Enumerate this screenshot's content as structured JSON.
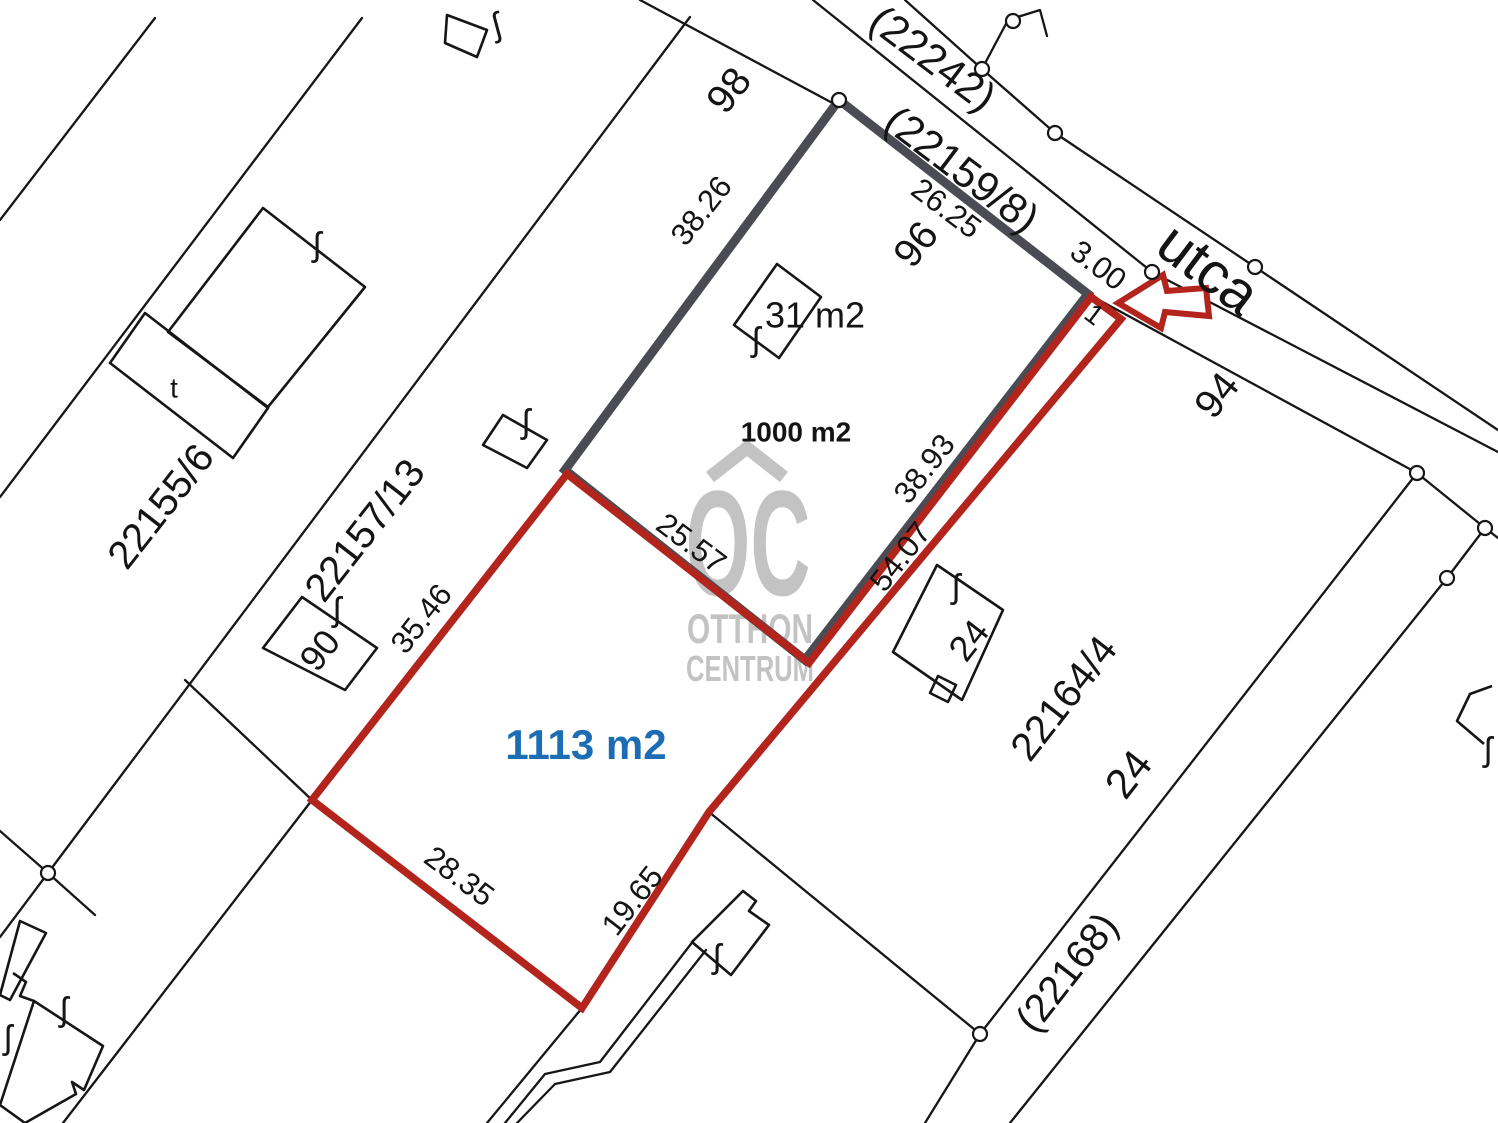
{
  "map": {
    "title": "cadastral-parcel-map",
    "canvas": {
      "width": 1498,
      "height": 1123,
      "background": "#ffffff"
    },
    "colors": {
      "thin_line": "#161616",
      "selected_gray": "#4b4b53",
      "highlight_red": "#b3251c",
      "area_blue": "#1d6db4",
      "watermark_gray": "#bdbdbd",
      "label_black": "#141414"
    },
    "selected_parcel": {
      "name": "parcel-1000-m2",
      "area_label": "1000 m2",
      "points": [
        [
          839,
          100
        ],
        [
          1088,
          294
        ],
        [
          805,
          660
        ],
        [
          565,
          470
        ]
      ],
      "stroke_width": 9
    },
    "highlighted_parcel": {
      "name": "parcel-1113-m2",
      "area_label": "1113 m2",
      "points": [
        [
          567,
          474
        ],
        [
          312,
          800
        ],
        [
          582,
          1008
        ],
        [
          709,
          812
        ],
        [
          1121,
          319
        ],
        [
          1091,
          297
        ],
        [
          809,
          663
        ]
      ],
      "stroke_width": 7.5
    },
    "arrow": {
      "points": [
        [
          1118,
          303
        ],
        [
          1163,
          275
        ],
        [
          1167,
          291
        ],
        [
          1206,
          288
        ],
        [
          1209,
          316
        ],
        [
          1165,
          312
        ],
        [
          1161,
          328
        ]
      ],
      "stroke_width": 6
    },
    "thin_lines": [
      [
        [
          640,
          0
        ],
        [
          840,
          107
        ]
      ],
      [
        [
          1088,
          294
        ],
        [
          1417,
          473
        ]
      ],
      [
        [
          1417,
          473
        ],
        [
          1485,
          528
        ]
      ],
      [
        [
          1485,
          528
        ],
        [
          1498,
          538
        ]
      ],
      [
        [
          813,
          0
        ],
        [
          1152,
          272
        ],
        [
          1498,
          452
        ]
      ],
      [
        [
          905,
          0
        ],
        [
          982,
          69
        ],
        [
          1055,
          133
        ],
        [
          1255,
          267
        ],
        [
          1498,
          430
        ]
      ],
      [
        [
          982,
          69
        ],
        [
          1008,
          20
        ]
      ],
      [
        [
          1008,
          20
        ],
        [
          1040,
          10
        ],
        [
          1047,
          36
        ]
      ],
      [
        [
          1417,
          473
        ],
        [
          980,
          1034
        ]
      ],
      [
        [
          980,
          1034
        ],
        [
          925,
          1123
        ]
      ],
      [
        [
          1485,
          528
        ],
        [
          1447,
          578
        ],
        [
          1010,
          1123
        ]
      ],
      [
        [
          709,
          812
        ],
        [
          980,
          1034
        ]
      ],
      [
        [
          155,
          18
        ],
        [
          0,
          220
        ]
      ],
      [
        [
          362,
          18
        ],
        [
          0,
          497
        ]
      ],
      [
        [
          690,
          17
        ],
        [
          48,
          873
        ],
        [
          0,
          937
        ]
      ],
      [
        [
          0,
          831
        ],
        [
          48,
          873
        ],
        [
          95,
          915
        ]
      ],
      [
        [
          185,
          680
        ],
        [
          312,
          800
        ]
      ],
      [
        [
          312,
          800
        ],
        [
          63,
          1123
        ]
      ],
      [
        [
          582,
          1008
        ],
        [
          487,
          1123
        ]
      ],
      [
        [
          694,
          940
        ],
        [
          600,
          1062
        ],
        [
          545,
          1074
        ],
        [
          505,
          1123
        ]
      ],
      [
        [
          706,
          950
        ],
        [
          610,
          1072
        ],
        [
          555,
          1084
        ],
        [
          517,
          1123
        ]
      ]
    ],
    "buildings": [
      {
        "closed": true,
        "points": [
          [
            447,
            15
          ],
          [
            487,
            30
          ],
          [
            477,
            57
          ],
          [
            445,
            43
          ]
        ]
      },
      {
        "closed": true,
        "points": [
          [
            263,
            208
          ],
          [
            365,
            287
          ],
          [
            268,
            407
          ],
          [
            168,
            332
          ]
        ]
      },
      {
        "closed": true,
        "points": [
          [
            145,
            313
          ],
          [
            268,
            408
          ],
          [
            233,
            458
          ],
          [
            110,
            363
          ]
        ]
      },
      {
        "closed": true,
        "points": [
          [
            503,
            415
          ],
          [
            547,
            440
          ],
          [
            527,
            468
          ],
          [
            483,
            445
          ]
        ]
      },
      {
        "closed": true,
        "points": [
          [
            777,
            264
          ],
          [
            821,
            297
          ],
          [
            779,
            358
          ],
          [
            734,
            325
          ]
        ]
      },
      {
        "closed": true,
        "points": [
          [
            302,
            597
          ],
          [
            377,
            648
          ],
          [
            345,
            690
          ],
          [
            263,
            648
          ]
        ]
      },
      {
        "closed": true,
        "points": [
          [
            937,
            565
          ],
          [
            1003,
            610
          ],
          [
            962,
            700
          ],
          [
            893,
            652
          ]
        ]
      },
      {
        "closed": true,
        "points": [
          [
            938,
            676
          ],
          [
            956,
            685
          ],
          [
            948,
            702
          ],
          [
            930,
            693
          ]
        ]
      },
      {
        "closed": true,
        "points": [
          [
            743,
            891
          ],
          [
            756,
            901
          ],
          [
            749,
            911
          ],
          [
            769,
            925
          ],
          [
            731,
            975
          ],
          [
            692,
            942
          ]
        ]
      },
      {
        "closed": false,
        "points": [
          [
            1492,
            686
          ],
          [
            1470,
            694
          ],
          [
            1457,
            721
          ],
          [
            1484,
            744
          ]
        ]
      },
      {
        "closed": true,
        "points": [
          [
            20,
            921
          ],
          [
            46,
            933
          ],
          [
            10,
            1000
          ],
          [
            0,
            995
          ]
        ]
      },
      {
        "closed": false,
        "points": [
          [
            13,
            973
          ],
          [
            26,
            982
          ],
          [
            20,
            996
          ],
          [
            34,
            1001
          ]
        ]
      },
      {
        "closed": true,
        "points": [
          [
            34,
            1001
          ],
          [
            103,
            1046
          ],
          [
            84,
            1090
          ],
          [
            72,
            1082
          ],
          [
            76,
            1094
          ],
          [
            25,
            1123
          ],
          [
            0,
            1105
          ]
        ]
      }
    ],
    "circles": [
      [
        839,
        100
      ],
      [
        982,
        69
      ],
      [
        1013,
        21
      ],
      [
        1055,
        133
      ],
      [
        1152,
        272
      ],
      [
        1255,
        267
      ],
      [
        1417,
        473
      ],
      [
        1485,
        528
      ],
      [
        1447,
        578
      ],
      [
        980,
        1034
      ],
      [
        48,
        873
      ]
    ],
    "f_symbols": {
      "glyph": "ʃ",
      "positions": [
        [
          497,
          27,
          -15
        ],
        [
          317,
          247,
          0
        ],
        [
          526,
          424,
          0
        ],
        [
          756,
          342,
          0
        ],
        [
          337,
          612,
          0
        ],
        [
          956,
          589,
          0
        ],
        [
          717,
          959,
          0
        ],
        [
          64,
          1012,
          0
        ],
        [
          8,
          1040,
          0
        ],
        [
          1488,
          752,
          0
        ]
      ]
    },
    "labels": [
      {
        "id": "parcel-98",
        "text": "98",
        "x": 731,
        "y": 92,
        "r": -52,
        "s": 40
      },
      {
        "id": "street-22242",
        "text": "(22242)",
        "x": 931,
        "y": 61,
        "r": 37,
        "s": 42
      },
      {
        "id": "street-22159-8",
        "text": "(22159/8)",
        "x": 960,
        "y": 172,
        "r": 37,
        "s": 42
      },
      {
        "id": "dim-26-25",
        "text": "26.25",
        "x": 945,
        "y": 210,
        "r": 37,
        "s": 31
      },
      {
        "id": "parcel-96",
        "text": "96",
        "x": 918,
        "y": 246,
        "r": -52,
        "s": 40
      },
      {
        "id": "street-utca",
        "text": "utca",
        "x": 1206,
        "y": 272,
        "r": 37,
        "s": 58
      },
      {
        "id": "dim-3-00",
        "text": "3.00",
        "x": 1097,
        "y": 267,
        "r": 37,
        "s": 31
      },
      {
        "id": "point-1",
        "text": "1",
        "x": 1093,
        "y": 316,
        "r": 37,
        "s": 28
      },
      {
        "id": "parcel-94",
        "text": "94",
        "x": 1219,
        "y": 397,
        "r": -52,
        "s": 40
      },
      {
        "id": "dim-38-26",
        "text": "38.26",
        "x": 703,
        "y": 212,
        "r": -52,
        "s": 31
      },
      {
        "id": "building-area-31",
        "text": "31 m2",
        "x": 815,
        "y": 318,
        "r": 0,
        "s": 36
      },
      {
        "id": "area-1000",
        "text": "1000 m2",
        "x": 796,
        "y": 434,
        "r": 0,
        "s": 28,
        "w": "bold"
      },
      {
        "id": "dim-38-93",
        "text": "38.93",
        "x": 926,
        "y": 470,
        "r": -52,
        "s": 31
      },
      {
        "id": "dim-54-07",
        "text": "54.07",
        "x": 902,
        "y": 558,
        "r": -52,
        "s": 31
      },
      {
        "id": "dim-25-57",
        "text": "25.57",
        "x": 690,
        "y": 545,
        "r": 37,
        "s": 31
      },
      {
        "id": "dim-35-46",
        "text": "35.46",
        "x": 423,
        "y": 620,
        "r": -52,
        "s": 31
      },
      {
        "id": "parcel-22157-13",
        "text": "22157/13",
        "x": 367,
        "y": 532,
        "r": -52,
        "s": 40
      },
      {
        "id": "parcel-22155-6",
        "text": "22155/6",
        "x": 163,
        "y": 508,
        "r": -52,
        "s": 40
      },
      {
        "id": "parcel-90",
        "text": "90",
        "x": 322,
        "y": 652,
        "r": -52,
        "s": 36
      },
      {
        "id": "mark-t",
        "text": "t",
        "x": 174,
        "y": 390,
        "r": 0,
        "s": 28
      },
      {
        "id": "area-1113",
        "text": "1113 m2",
        "x": 586,
        "y": 748,
        "r": 0,
        "s": 42,
        "w": "bold",
        "c": "#1d6db4"
      },
      {
        "id": "dim-28-35",
        "text": "28.35",
        "x": 458,
        "y": 878,
        "r": 37,
        "s": 31
      },
      {
        "id": "dim-19-65",
        "text": "19.65",
        "x": 634,
        "y": 902,
        "r": -52,
        "s": 31
      },
      {
        "id": "parcel-22164-4",
        "text": "22164/4",
        "x": 1066,
        "y": 700,
        "r": -52,
        "s": 40
      },
      {
        "id": "street-24",
        "text": "24",
        "x": 1131,
        "y": 776,
        "r": -52,
        "s": 42
      },
      {
        "id": "building-24",
        "text": "24",
        "x": 971,
        "y": 642,
        "r": -52,
        "s": 36
      },
      {
        "id": "street-22168",
        "text": "(22168)",
        "x": 1069,
        "y": 974,
        "r": -52,
        "s": 40
      }
    ],
    "watermark": {
      "roof": [
        [
          710,
          477
        ],
        [
          747,
          448
        ],
        [
          784,
          477
        ]
      ],
      "logo_text": "OC",
      "line1": "OTTHON",
      "line2": "CENTRUM",
      "logo": {
        "x": 748,
        "y": 595,
        "size": 150,
        "length": 125
      },
      "l1": {
        "x": 750,
        "y": 643,
        "size": 42,
        "length": 126
      },
      "l2": {
        "x": 750,
        "y": 681,
        "size": 36,
        "length": 128
      }
    }
  }
}
